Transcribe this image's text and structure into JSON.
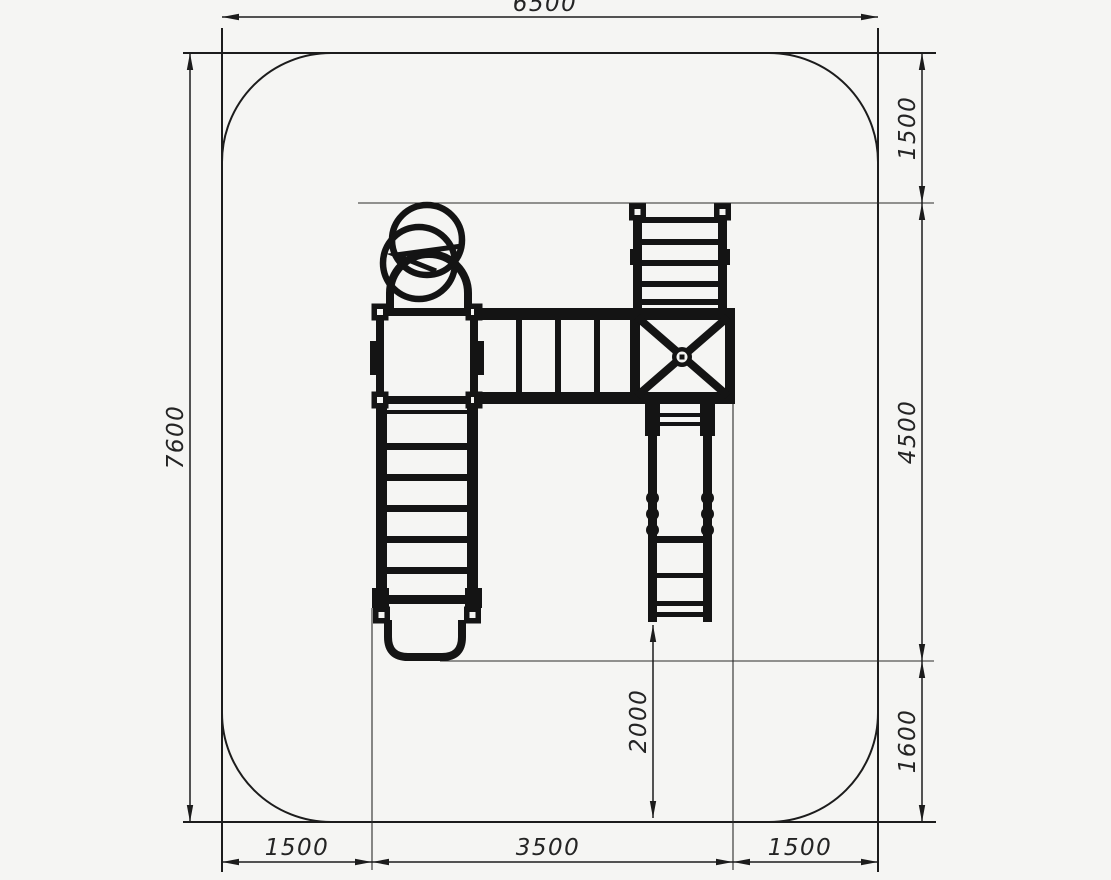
{
  "drawing": {
    "type": "playground-equipment-plan-view",
    "background_color": "#f5f5f3",
    "line_color": "#1c1c1c",
    "dimensions": {
      "top_width": "6500",
      "left_height": "7600",
      "right": [
        "1500",
        "4500",
        "1600"
      ],
      "bottom": [
        "1500",
        "3500",
        "1500"
      ],
      "inner_clearance": "2000"
    }
  }
}
